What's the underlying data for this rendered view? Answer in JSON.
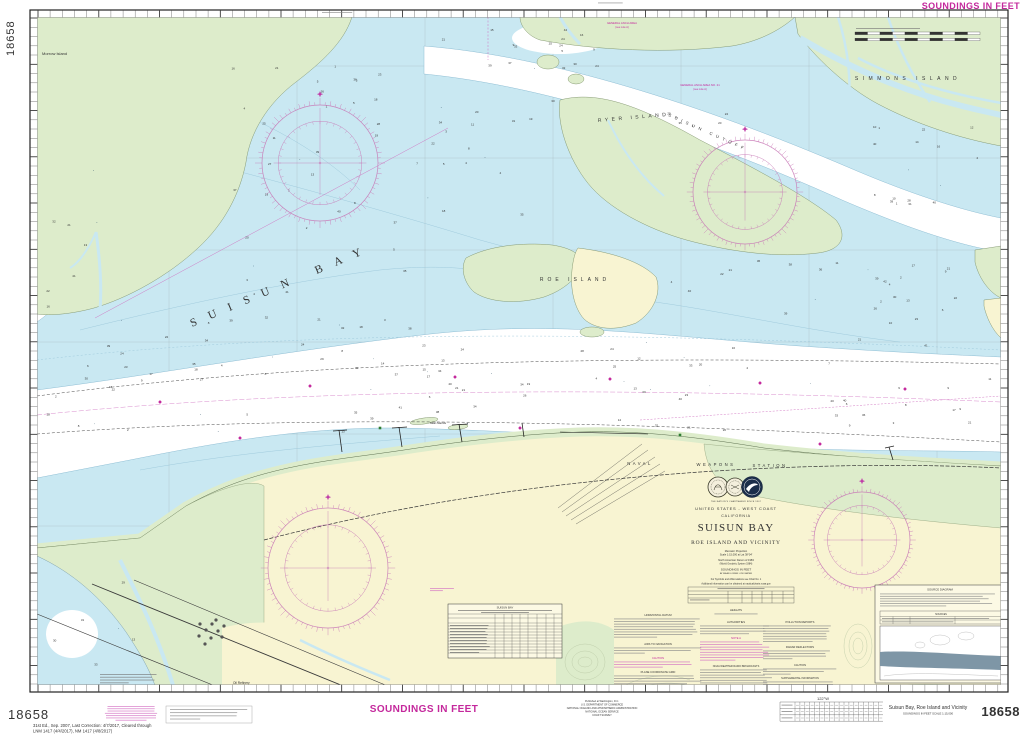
{
  "chart_number": "18658",
  "colors": {
    "magenta": "#c4289c",
    "water_blue": "#c9e8f2",
    "deep_white": "#ffffff",
    "marsh_green": "#ddeccb",
    "land_yellow": "#f8f4d2",
    "rose_magenta": "#c878b6"
  },
  "header": {
    "soundings_banner": "SOUNDINGS IN FEET"
  },
  "title_block": {
    "tagline": "THE NATION'S CHARTMAKER SINCE 1807",
    "nation": "UNITED STATES - WEST COAST",
    "state": "CALIFORNIA",
    "title": "SUISUN BAY",
    "subtitle": "ROE ISLAND AND VICINITY",
    "projection": "Mercator Projection",
    "scale_line": "Scale 1:15,000 at Lat 38°04'",
    "datum_line1": "North American Datum of 1983",
    "datum_line2": "(World Geodetic System 1984)",
    "soundings_line1": "SOUNDINGS IN FEET",
    "soundings_line2": "AT MEAN LOWER LOW WATER",
    "symbols_note": "For Symbols and Abbreviations see Chart No. 1",
    "info_note": "Additional information can be obtained at nauticalcharts.noaa.gov"
  },
  "place_labels": {
    "suisun_bay": "SUISUN BAY",
    "suisun_cutoff": "SUISUN CUTOFF",
    "roe_island": "ROE ISLAND",
    "ryer_island": "RYER ISLAND",
    "simmons_island": "SIMMONS ISLAND",
    "morrow_island": "Morrow Island",
    "naval": "NAVAL",
    "weapons": "WEAPONS",
    "station": "STATION",
    "seal_islands": "Seal Islands",
    "oil_refinery": "Oil Refinery"
  },
  "anchorages": {
    "a1_line1": "GENERAL ANCH AREA NO. 21",
    "a1_line2": "(see note A)",
    "a2_line1": "GENERAL ANCH AREA",
    "a2_line2": "(see note A)"
  },
  "notes": {
    "col1": [
      "HORIZONTAL DATUM",
      "AIDS TO NAVIGATION",
      "CAUTION",
      "PLANE COORDINATE GRID"
    ],
    "col2": [
      "HEIGHTS",
      "AUTHORITIES",
      "NOTE A",
      "NOAA WEATHER RADIO BROADCASTS"
    ],
    "col3": [
      "POLLUTION REPORTS",
      "RADAR REFLECTORS",
      "CAUTION",
      "SUPPLEMENTAL INFORMATION"
    ]
  },
  "tables": {
    "controlling_depths_title": "SUISUN BAY"
  },
  "source_diagram": {
    "title": "SOURCE DIAGRAM",
    "legend_title": "SOURCES"
  },
  "footer": {
    "edition_line1": "31st Ed., Sep. 2007, Last Correction: 4/7/2017, Cleared through",
    "edition_line2": "LNM 1417 (4/4/2017), NM 1417 (4/8/2017)",
    "soundings_banner": "SOUNDINGS IN FEET",
    "publisher_line1": "Published at Washington, D.C.",
    "publisher_line2": "U.S. DEPARTMENT OF COMMERCE",
    "publisher_line3": "NATIONAL OCEANIC AND ATMOSPHERIC ADMINISTRATION",
    "publisher_line4": "NATIONAL OCEAN SERVICE",
    "publisher_line5": "COAST SURVEY",
    "title": "Suisun Bay, Roe Island and Vicinity",
    "subtitle": "SOUNDINGS IN FEET    SCALE 1:15,000",
    "lon_label": "122°W"
  }
}
